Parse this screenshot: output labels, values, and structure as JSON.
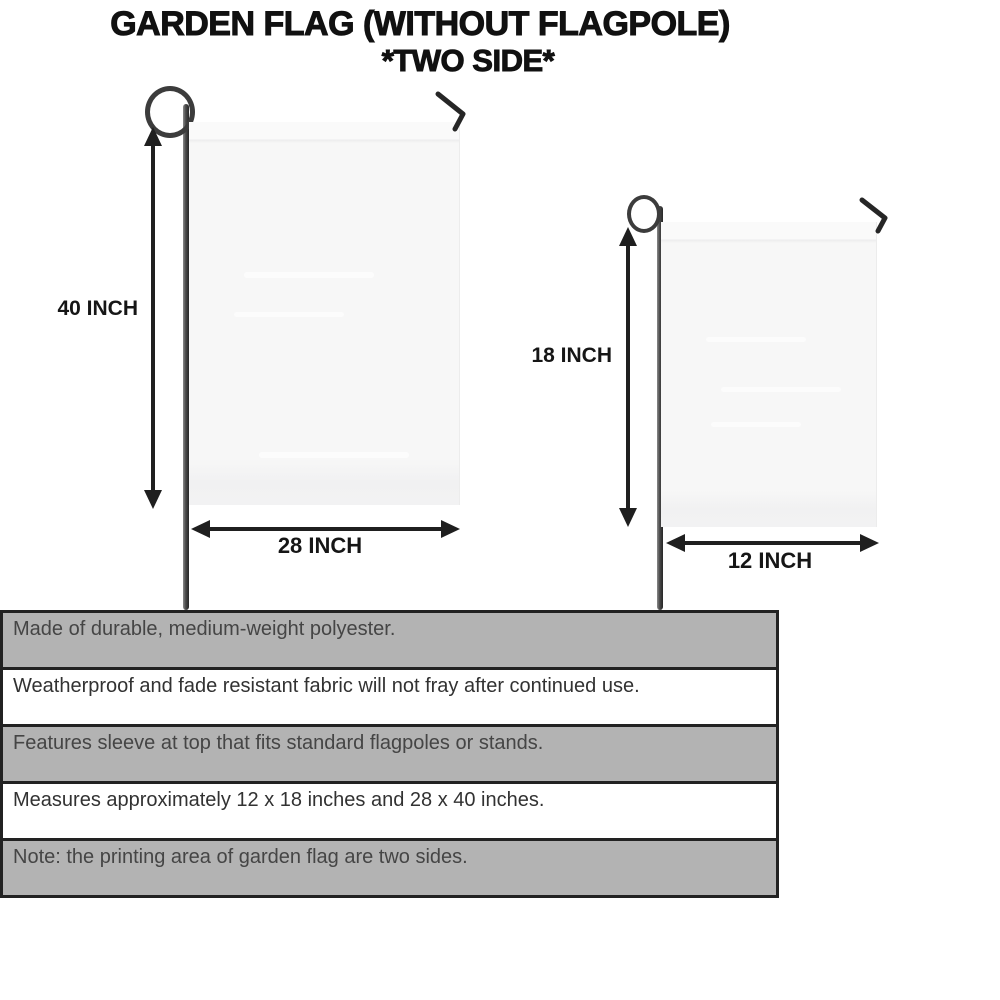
{
  "title": {
    "line1": "GARDEN FLAG (WITHOUT FLAGPOLE)",
    "line2": "*TWO SIDE*"
  },
  "diagram": {
    "large_flag": {
      "height_label": "40 INCH",
      "width_label": "28 INCH",
      "height_in": 40,
      "width_in": 28
    },
    "small_flag": {
      "height_label": "18 INCH",
      "width_label": "12 INCH",
      "height_in": 18,
      "width_in": 12
    }
  },
  "features": {
    "rows": [
      {
        "text": "Made of durable, medium-weight polyester.",
        "shade": "gray"
      },
      {
        "text": "Weatherproof and fade resistant fabric will not fray after continued use.",
        "shade": "white"
      },
      {
        "text": "Features sleeve at top that fits standard flagpoles or stands.",
        "shade": "gray"
      },
      {
        "text": "Measures approximately 12 x 18 inches and 28 x 40 inches.",
        "shade": "white"
      },
      {
        "text": "Note: the printing area of garden flag are two sides.",
        "shade": "gray"
      }
    ]
  },
  "colors": {
    "row_gray": "#b3b3b3",
    "row_white": "#ffffff",
    "table_border": "#222222",
    "title_text": "#111111",
    "label_text": "#161616",
    "pole": "#3c3c3c",
    "flag_fill": "#f7f7f7",
    "arrow": "#1f1f1f"
  }
}
